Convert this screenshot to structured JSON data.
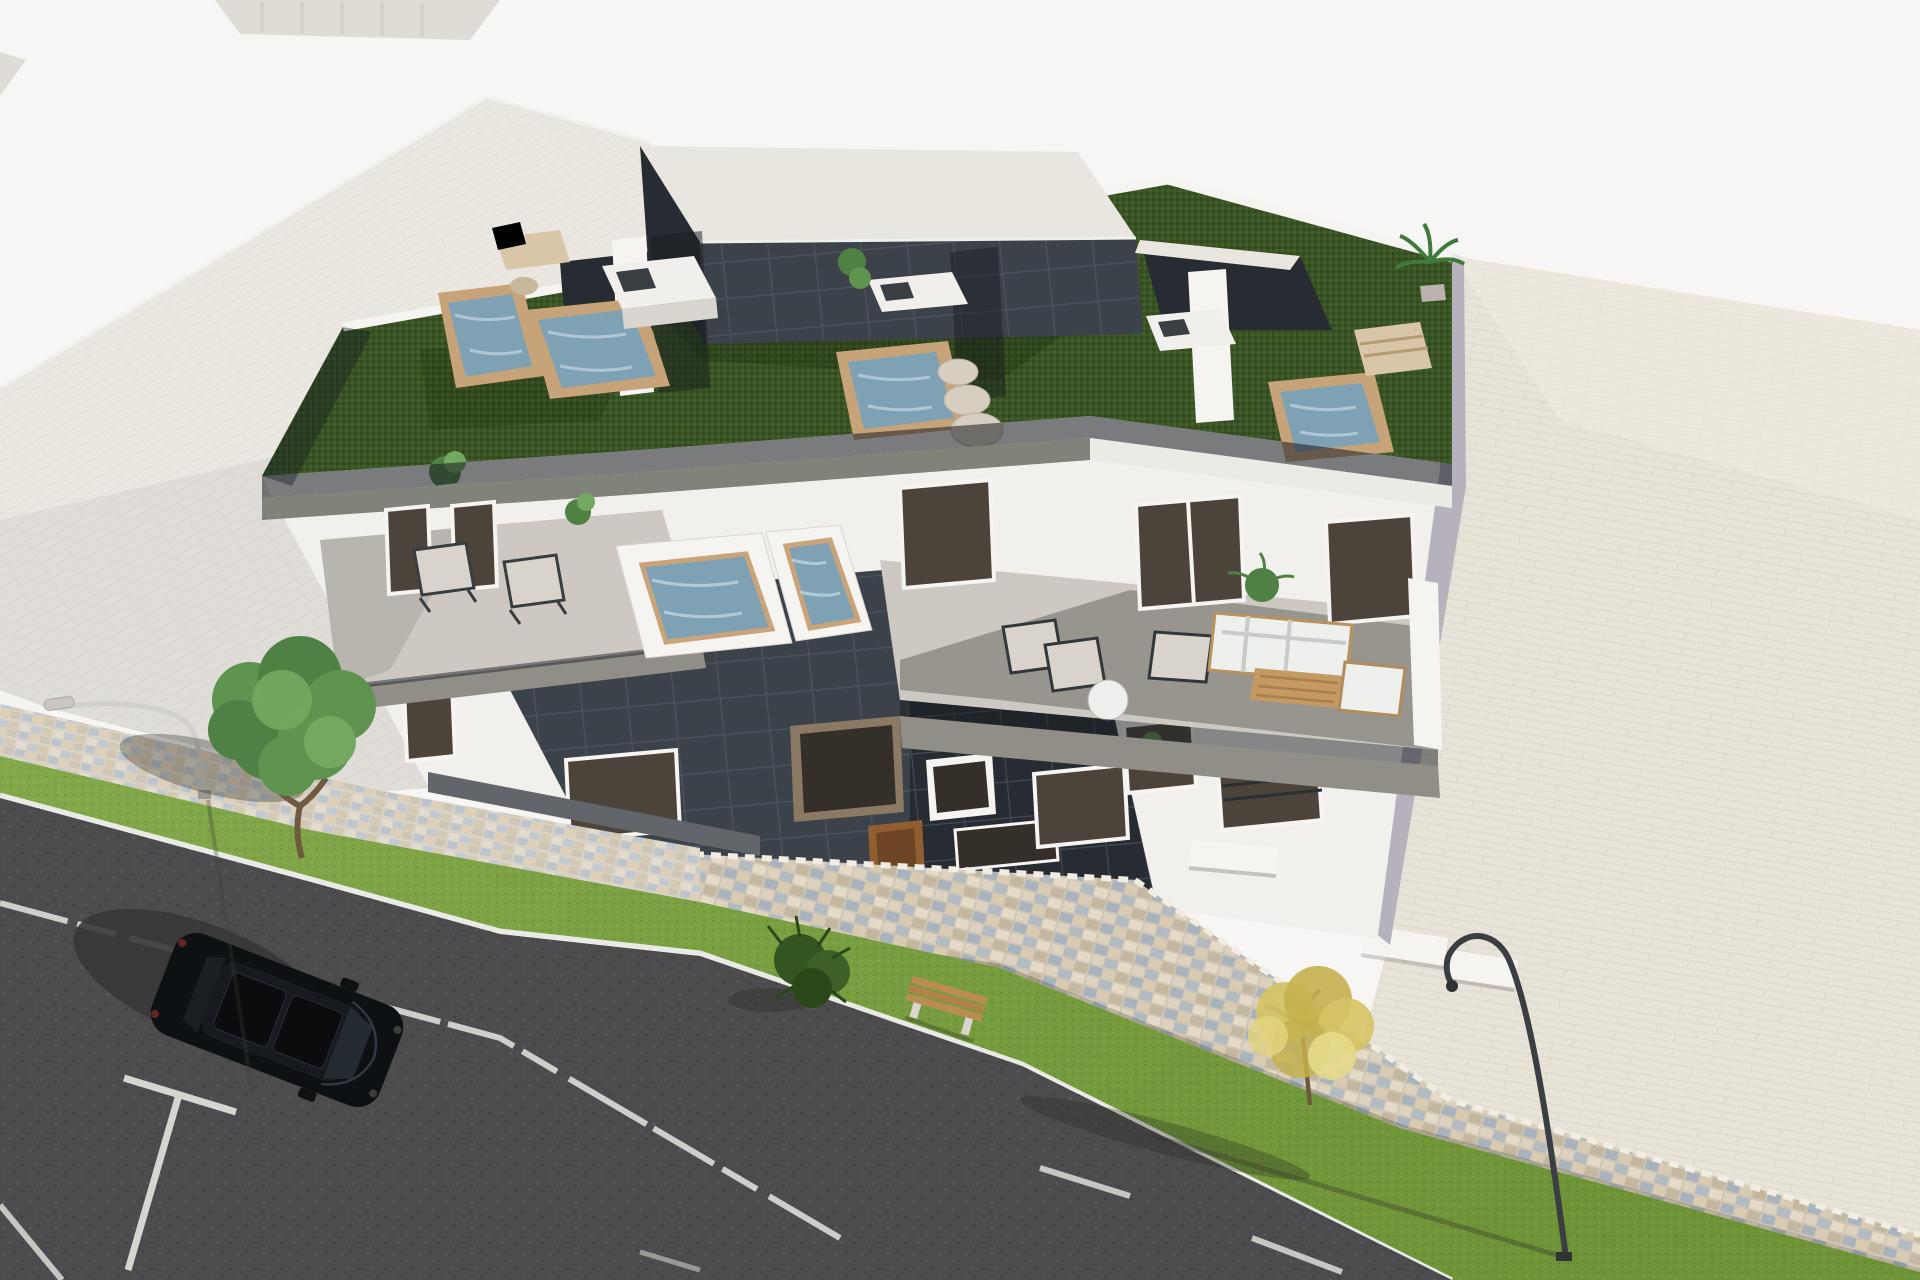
{
  "meta": {
    "type": "architectural-3d-render",
    "title": "Aerial 3D rendering of a modern three-storey apartment building with rooftop pools, green roof terraces and street frontage",
    "canvas": {
      "width": 1920,
      "height": 1280
    },
    "no_visible_text": true
  },
  "scene": {
    "viewpoint": "high aerial, looking down at the building from the street side",
    "areas": {
      "background": "plain warm-white ground / sky plane",
      "top_left": "flat light-grey roof and wall planes of a neighbouring building",
      "right": "large beige paved ground plane behind the building",
      "bottom_left": "dark asphalt street with white lane and parking markings",
      "street_edge": "grass verge, multicolour cobblestone sidewalk and stone retaining wall"
    },
    "building": {
      "storeys": 3,
      "facade_color": "white",
      "accent_volume": "dark grey tiled two-storey panel with entrance door",
      "roof": "green artificial turf garden with glass partitions, white parapets and dark tiled penthouse boxes"
    },
    "objects": {
      "rooftop_plunge_pools": 4,
      "terrace_pools": 2,
      "outdoor_kitchens": 3,
      "sun_loungers": 6,
      "outdoor_sofa_sets": 1,
      "round_stone_stools": 3,
      "potted_plants": 6,
      "parked_cars": 1,
      "street_lamps": 2,
      "benches": 1,
      "bushes": 1,
      "trees": [
        "green leafy tree near neighbouring building",
        "yellow autumn tree at lower right"
      ]
    },
    "car": {
      "color": "black",
      "type": "SUV seen from above",
      "location": "parked on asphalt parking bay"
    }
  },
  "palette": {
    "bg": "#f7f6f4",
    "far_building": "#dfdcd5",
    "neighbor": "#eae7e1",
    "apron": "#f4f3f0",
    "beige_plane": "#e8e3d8",
    "facade": "#f2f0ec",
    "side_wall": "#b6b1bc",
    "turf": "#3a5224",
    "deck": "#e9e6df",
    "tile": "#3c424a",
    "tile_dark": "#272c32",
    "fascia": "#7f8378",
    "fascia_white": "#eceae5",
    "glass_band": "#171b20",
    "terrace_floor": "#cdc9c2",
    "slab": "#908e86",
    "water": "#7fa1b4",
    "wood": "#c7a37a",
    "counter": "#f1efeb",
    "stone_wall": "#cfc5b4",
    "sidewalk": "#d9d3c7",
    "asphalt": "#4c4c4e",
    "road_mark": "#e6e5e0",
    "plinth": "#62666a",
    "door": "#915e32",
    "window_glass": "#4c443a",
    "tree_green": "#5f9350",
    "tree_yellow": "#d6c365",
    "grass_light": "#83a94a",
    "grass_dark": "#6d9336"
  }
}
